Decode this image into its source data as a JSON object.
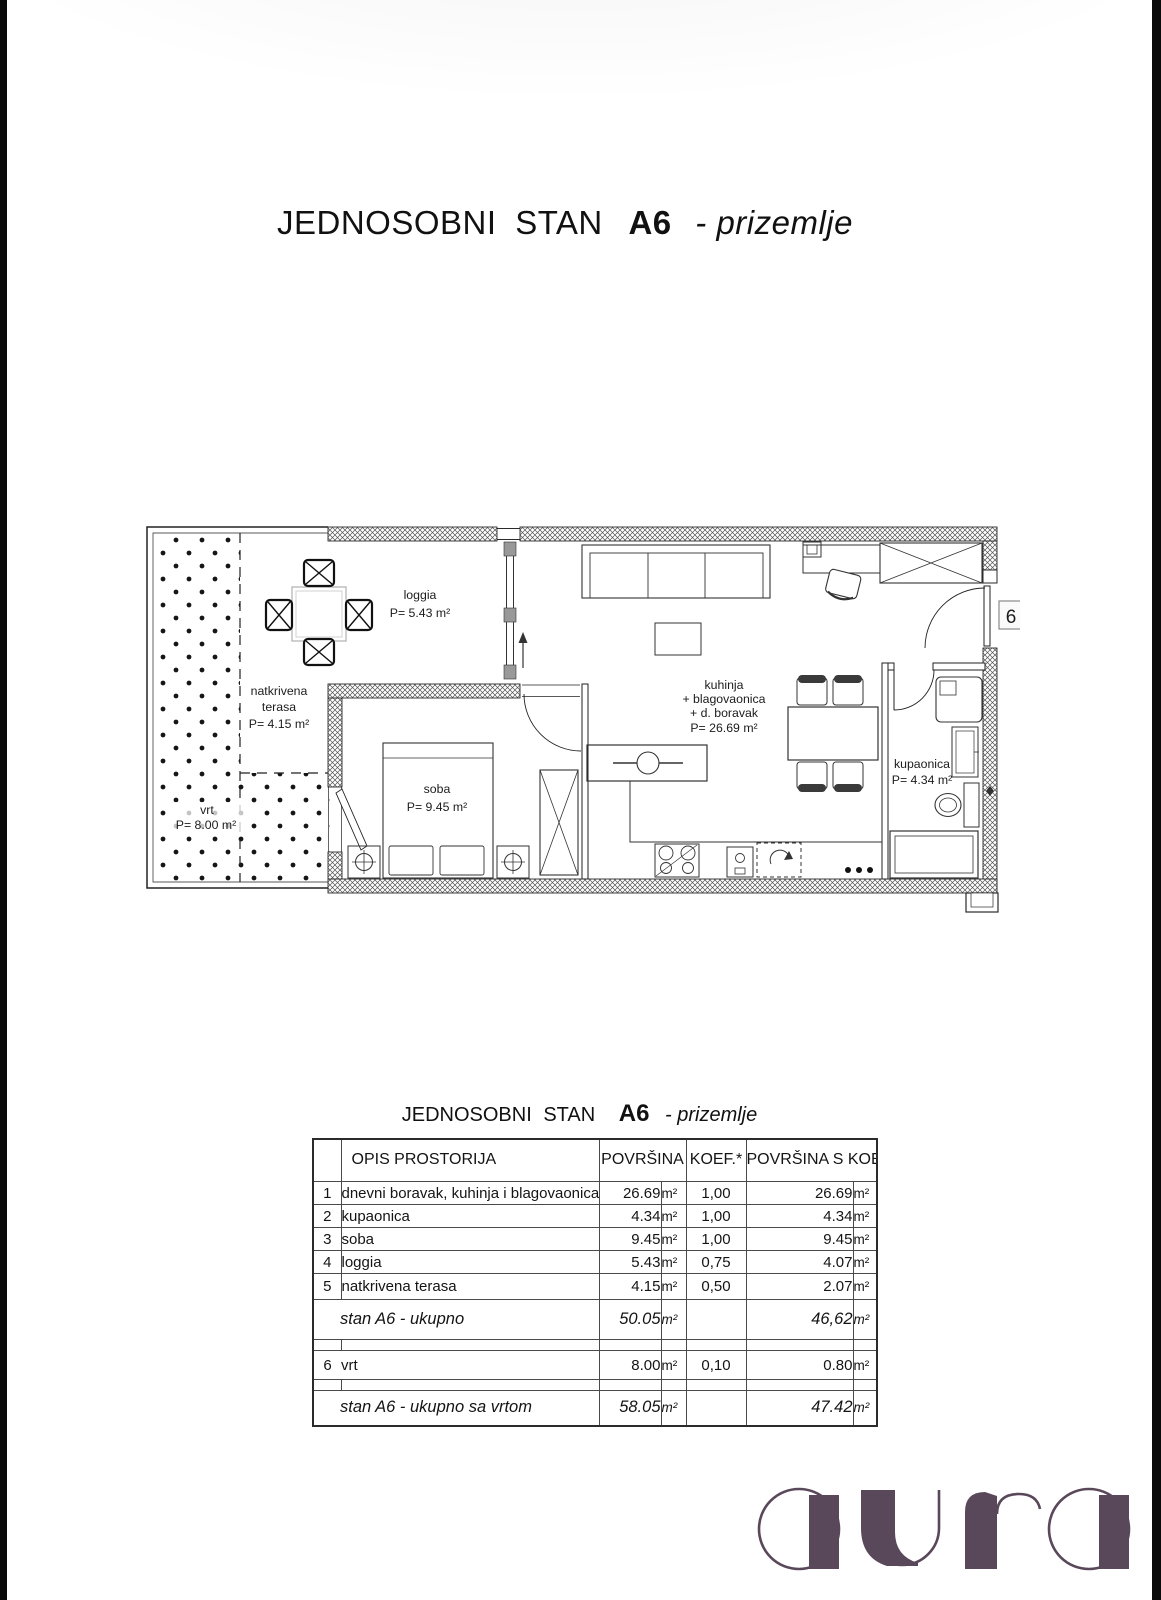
{
  "page": {
    "title_main": "JEDNOSOBNI STAN",
    "title_unit": "A6",
    "title_floor": "- prizemlje"
  },
  "floor_plan": {
    "unit_number": "6",
    "labels": {
      "loggia": [
        "loggia",
        "P= 5.43 m²"
      ],
      "terasa": [
        "natkrivena",
        "terasa",
        "P= 4.15 m²"
      ],
      "vrt": [
        "vrt",
        "P= 8.00 m²"
      ],
      "soba": [
        "soba",
        "P= 9.45 m²"
      ],
      "kuhinja": [
        "kuhinja",
        "+ blagovaonica",
        "+ d. boravak",
        "P= 26.69 m²"
      ],
      "kupaonica": [
        "kupaonica",
        "P= 4.34 m²"
      ]
    }
  },
  "table": {
    "headers": {
      "opis": "OPIS PROSTORIJA",
      "povrsina": "POVRŠINA",
      "koef": "KOEF.*",
      "povrsina_s_koef": "POVRŠINA S KOEF."
    },
    "unit": "m²",
    "rows": [
      {
        "num": "1",
        "opis": "dnevni boravak, kuhinja i blagovaonica",
        "povrsina": "26.69",
        "koef": "1,00",
        "povrsina_s": "26.69"
      },
      {
        "num": "2",
        "opis": "kupaonica",
        "povrsina": "4.34",
        "koef": "1,00",
        "povrsina_s": "4.34"
      },
      {
        "num": "3",
        "opis": "soba",
        "povrsina": "9.45",
        "koef": "1,00",
        "povrsina_s": "9.45"
      },
      {
        "num": "4",
        "opis": "loggia",
        "povrsina": "5.43",
        "koef": "0,75",
        "povrsina_s": "4.07"
      },
      {
        "num": "5",
        "opis": "natkrivena terasa",
        "povrsina": "4.15",
        "koef": "0,50",
        "povrsina_s": "2.07"
      }
    ],
    "subtotal": {
      "opis": "stan A6 - ukupno",
      "povrsina": "50.05",
      "povrsina_s": "46,62"
    },
    "vrt_row": {
      "num": "6",
      "opis": "vrt",
      "povrsina": "8.00",
      "koef": "0,10",
      "povrsina_s": "0.80"
    },
    "total": {
      "opis": "stan A6 - ukupno sa vrtom",
      "povrsina": "58.05",
      "povrsina_s": "47.42"
    }
  },
  "logo": {
    "text": "aura",
    "color": "#59475a"
  }
}
